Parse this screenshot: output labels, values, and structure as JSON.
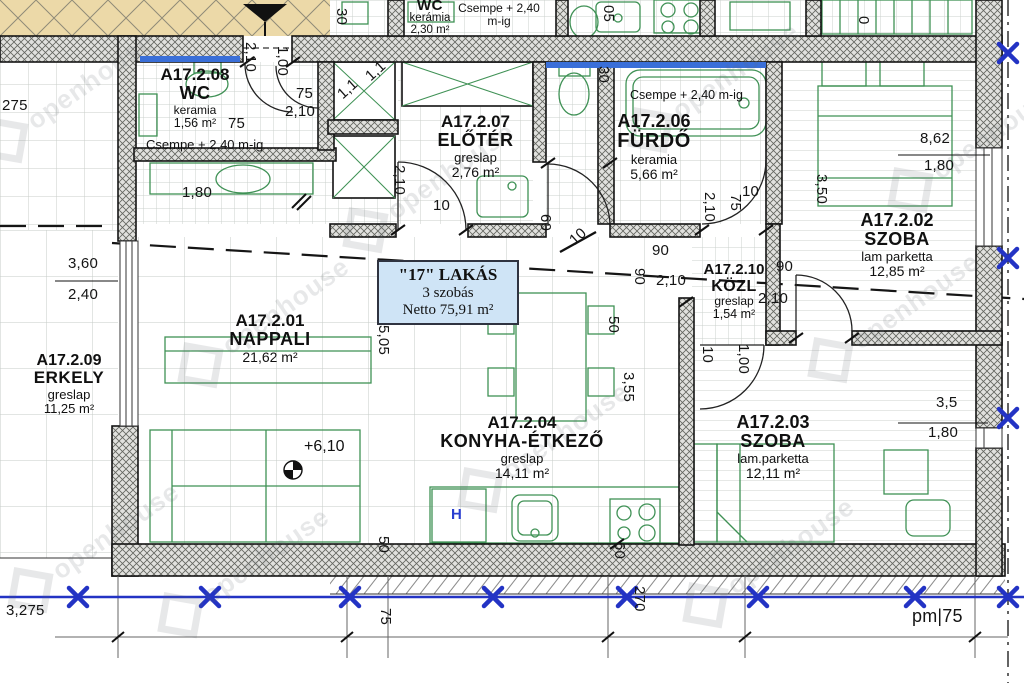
{
  "title_box": {
    "line1": "\"17\" LAKÁS",
    "line2": "3 szobás",
    "line3": "Netto 75,91 m²"
  },
  "rooms": {
    "wc_upper": {
      "name": "WC",
      "material": "kerámia",
      "area": "2,30 m²"
    },
    "wc208": {
      "id": "A17.2.08",
      "name": "WC",
      "material": "keramia",
      "area": "1,56 m²"
    },
    "eloter": {
      "id": "A17.2.07",
      "name": "ELŐTÉR",
      "material": "greslap",
      "area": "2,76 m²"
    },
    "furdo": {
      "id": "A17.2.06",
      "name": "FÜRDŐ",
      "material": "keramia",
      "area": "5,66 m²"
    },
    "szoba02": {
      "id": "A17.2.02",
      "name": "SZOBA",
      "material": "lam parketta",
      "area": "12,85 m²"
    },
    "kozl": {
      "id": "A17.2.10",
      "name": "KÖZL",
      "material": "greslap",
      "area": "1,54 m²"
    },
    "nappali": {
      "id": "A17.2.01",
      "name": "NAPPALI",
      "area": "21,62 m²"
    },
    "erkely": {
      "id": "A17.2.09",
      "name": "ERKELY",
      "material": "greslap",
      "area": "11,25 m²"
    },
    "konyha": {
      "id": "A17.2.04",
      "name": "KONYHA-ÉTKEZŐ",
      "material": "greslap",
      "area": "14,11 m²"
    },
    "szoba03": {
      "id": "A17.2.03",
      "name": "SZOBA",
      "material": "lam.parketta",
      "area": "12,11 m²"
    }
  },
  "notes": {
    "csempe": "Csempe + 2,40 m-ig",
    "elevation": "+6,10",
    "fridge": "H"
  },
  "dimensions": [
    {
      "t": "30",
      "x": 350,
      "y": 8,
      "r": 90
    },
    {
      "t": "05",
      "x": 617,
      "y": 5,
      "r": 90
    },
    {
      "t": "0",
      "x": 872,
      "y": 16,
      "r": 90
    },
    {
      "t": "2,10",
      "x": 259,
      "y": 42,
      "r": 90
    },
    {
      "t": "1,00",
      "x": 291,
      "y": 46,
      "r": 90
    },
    {
      "t": "75",
      "x": 296,
      "y": 85,
      "r": 0
    },
    {
      "t": "2,10",
      "x": 285,
      "y": 103,
      "r": 0
    },
    {
      "t": "75",
      "x": 228,
      "y": 115,
      "r": 0
    },
    {
      "t": "1,1",
      "x": 362,
      "y": 72,
      "r": -42
    },
    {
      "t": "1,1",
      "x": 334,
      "y": 90,
      "r": -42
    },
    {
      "t": "1,80",
      "x": 182,
      "y": 184,
      "r": 0
    },
    {
      "t": "275",
      "x": 2,
      "y": 97,
      "r": 0
    },
    {
      "t": "3,60",
      "x": 68,
      "y": 255,
      "r": 0
    },
    {
      "t": "2,40",
      "x": 68,
      "y": 286,
      "r": 0
    },
    {
      "t": "5,05",
      "x": 392,
      "y": 325,
      "r": 90
    },
    {
      "t": "2,10",
      "x": 408,
      "y": 165,
      "r": 90
    },
    {
      "t": "10",
      "x": 433,
      "y": 197,
      "r": 0
    },
    {
      "t": "60",
      "x": 554,
      "y": 214,
      "r": 90
    },
    {
      "t": "30",
      "x": 612,
      "y": 66,
      "r": 90
    },
    {
      "t": "10",
      "x": 742,
      "y": 183,
      "r": 0
    },
    {
      "t": "75",
      "x": 744,
      "y": 194,
      "r": 90
    },
    {
      "t": "2,10",
      "x": 718,
      "y": 192,
      "r": 90
    },
    {
      "t": "8,62",
      "x": 920,
      "y": 130,
      "r": 0
    },
    {
      "t": "1,80",
      "x": 924,
      "y": 157,
      "r": 0
    },
    {
      "t": "3,50",
      "x": 830,
      "y": 174,
      "r": 90
    },
    {
      "t": "10",
      "x": 566,
      "y": 236,
      "r": -42
    },
    {
      "t": "90",
      "x": 652,
      "y": 242,
      "r": 0
    },
    {
      "t": "90",
      "x": 648,
      "y": 268,
      "r": 90
    },
    {
      "t": "2,10",
      "x": 656,
      "y": 272,
      "r": 0
    },
    {
      "t": "90",
      "x": 776,
      "y": 258,
      "r": 0
    },
    {
      "t": "2,10",
      "x": 758,
      "y": 290,
      "r": 0
    },
    {
      "t": "10",
      "x": 716,
      "y": 346,
      "r": 90
    },
    {
      "t": "1,00",
      "x": 752,
      "y": 344,
      "r": 90
    },
    {
      "t": "50",
      "x": 622,
      "y": 316,
      "r": 90
    },
    {
      "t": "3,55",
      "x": 637,
      "y": 372,
      "r": 90
    },
    {
      "t": "3,5",
      "x": 936,
      "y": 394,
      "r": 0
    },
    {
      "t": "1,80",
      "x": 928,
      "y": 424,
      "r": 0
    },
    {
      "t": "50",
      "x": 392,
      "y": 536,
      "r": 90
    },
    {
      "t": "60",
      "x": 628,
      "y": 542,
      "r": 90
    },
    {
      "t": "3,275",
      "x": 6,
      "y": 602,
      "r": 0
    },
    {
      "t": "75",
      "x": 394,
      "y": 608,
      "r": 90
    },
    {
      "t": "270",
      "x": 648,
      "y": 586,
      "r": 90
    },
    {
      "t": "pm|75",
      "x": 912,
      "y": 606,
      "r": 0,
      "s": 18
    }
  ],
  "watermark": {
    "text": "openhouse",
    "positions": [
      [
        70,
        95
      ],
      [
        265,
        320
      ],
      [
        95,
        545
      ],
      [
        430,
        185
      ],
      [
        545,
        445
      ],
      [
        245,
        570
      ],
      [
        715,
        85
      ],
      [
        895,
        315
      ],
      [
        770,
        560
      ],
      [
        975,
        145
      ]
    ]
  },
  "colors": {
    "section_blue": "#2333c4",
    "tile_note_blue": "#3a6fd8",
    "title_box_bg": "#cfe4f6",
    "common_area_tan": "#ecd9a8",
    "fixture_green": "#3f9155"
  }
}
